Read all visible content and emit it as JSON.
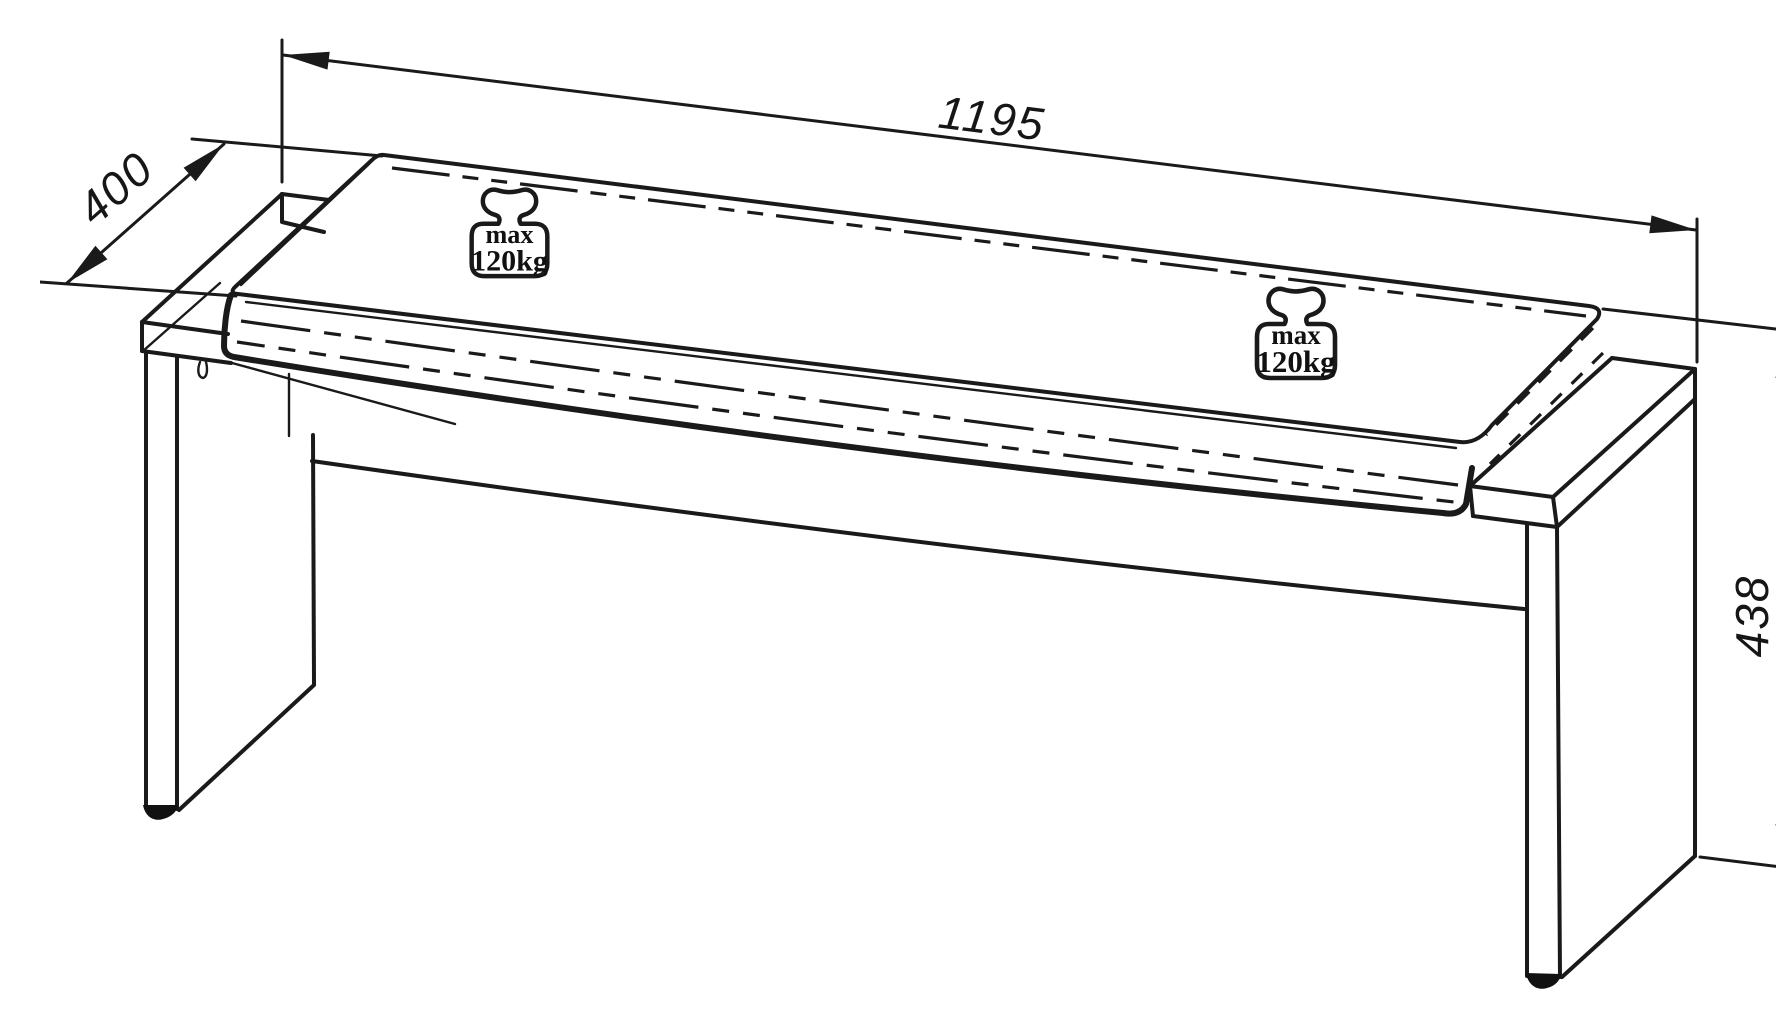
{
  "drawing": {
    "title": "bench-technical-drawing",
    "object": "bench-with-seat-cushion",
    "colors": {
      "line": "#1a1a1a",
      "background": "#ffffff"
    },
    "dimensions": {
      "length": {
        "value": "1195",
        "orientation": "top-slanted"
      },
      "depth": {
        "value": "400",
        "orientation": "diagonal-left"
      },
      "height": {
        "value": "438",
        "orientation": "vertical-right"
      }
    },
    "load_badges": [
      {
        "icon": "weight-icon",
        "line1": "max",
        "line2": "120kg"
      },
      {
        "icon": "weight-icon",
        "line1": "max",
        "line2": "120kg"
      }
    ]
  }
}
